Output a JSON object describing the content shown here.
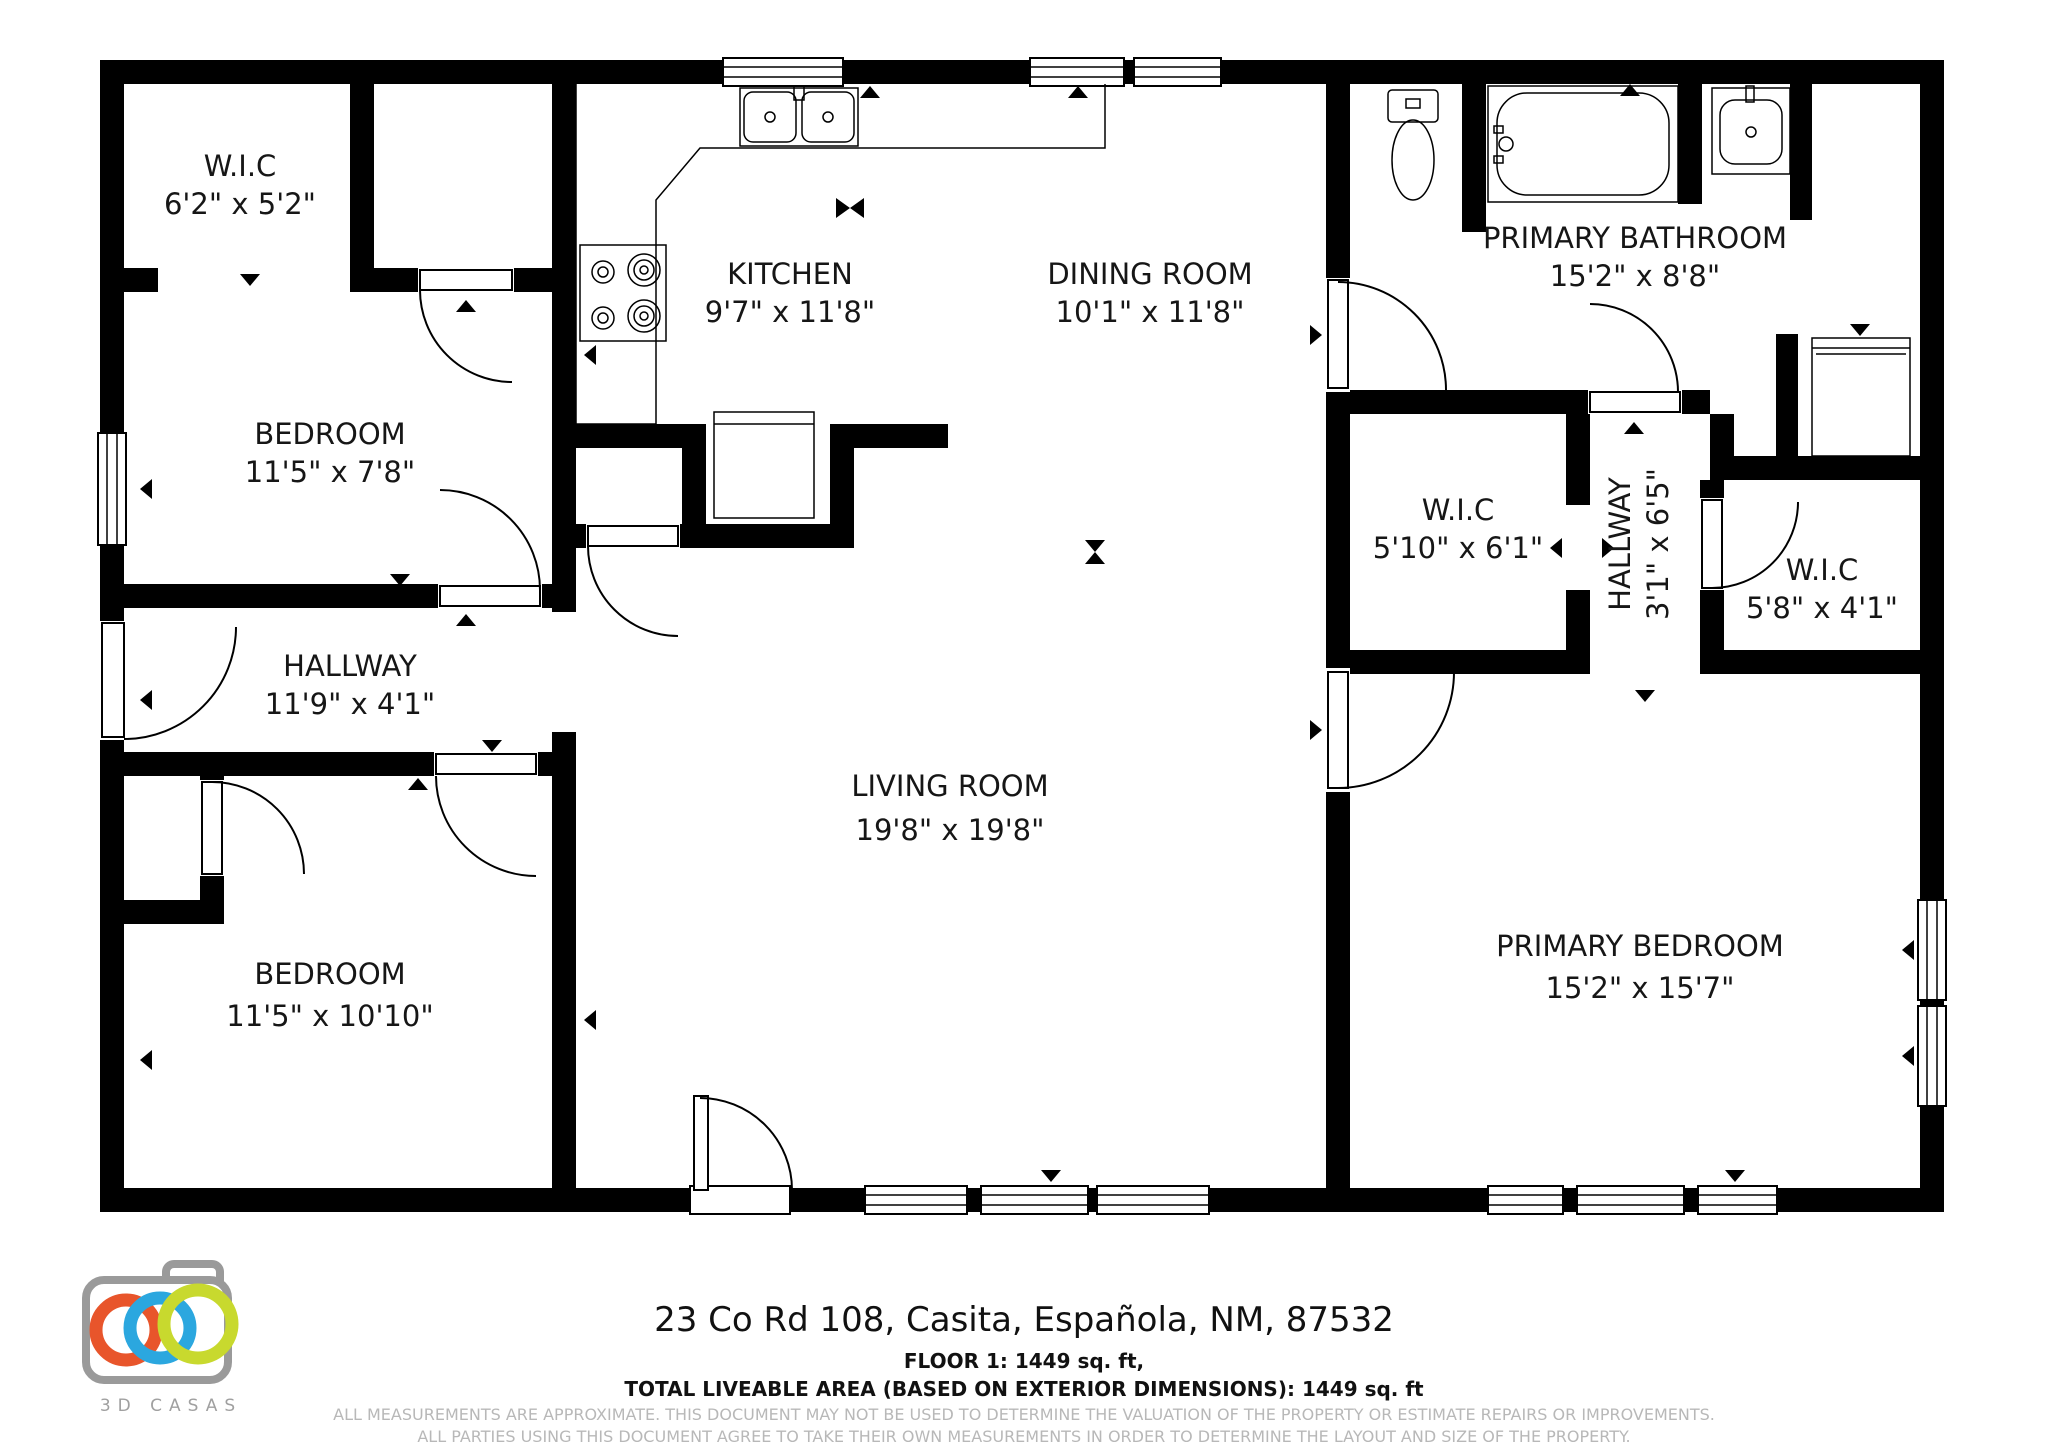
{
  "floor_plan": {
    "rooms": {
      "wic_left": {
        "name": "W.I.C",
        "dims": "6'2\" x 5'2\""
      },
      "bedroom_top": {
        "name": "BEDROOM",
        "dims": "11'5\" x 7'8\""
      },
      "kitchen": {
        "name": "KITCHEN",
        "dims": "9'7\" x 11'8\""
      },
      "dining_room": {
        "name": "DINING ROOM",
        "dims": "10'1\" x 11'8\""
      },
      "primary_bathroom": {
        "name": "PRIMARY BATHROOM",
        "dims": "15'2\" x 8'8\""
      },
      "wic_middle": {
        "name": "W.I.C",
        "dims": "5'10\" x 6'1\""
      },
      "hallway_small": {
        "name": "HALLWAY",
        "dims": "3'1\" x 6'5\""
      },
      "wic_right": {
        "name": "W.I.C",
        "dims": "5'8\" x 4'1\""
      },
      "hallway_main": {
        "name": "HALLWAY",
        "dims": "11'9\" x 4'1\""
      },
      "living_room": {
        "name": "LIVING ROOM",
        "dims": "19'8\" x 19'8\""
      },
      "bedroom_bottom": {
        "name": "BEDROOM",
        "dims": "11'5\" x 10'10\""
      },
      "primary_bedroom": {
        "name": "PRIMARY BEDROOM",
        "dims": "15'2\" x 15'7\""
      }
    }
  },
  "footer": {
    "address": "23 Co Rd 108, Casita, Española, NM, 87532",
    "floor_line": "FLOOR 1: 1449 sq. ft,",
    "total_line": "TOTAL LIVEABLE AREA (BASED ON EXTERIOR DIMENSIONS): 1449 sq. ft",
    "disclaimer_line1": "ALL MEASUREMENTS ARE APPROXIMATE. THIS DOCUMENT MAY NOT BE USED TO DETERMINE THE VALUATION OF THE PROPERTY OR ESTIMATE REPAIRS OR IMPROVEMENTS.",
    "disclaimer_line2": "ALL PARTIES USING THIS DOCUMENT AGREE TO TAKE THEIR OWN MEASUREMENTS IN ORDER TO DETERMINE THE LAYOUT AND SIZE OF THE PROPERTY."
  },
  "logo": {
    "brand": "3D CASAS"
  },
  "colors": {
    "wall": "#000000",
    "label_text": "#161616",
    "disclaimer_text": "#b8b8b8",
    "logo_camera": "#9a9a9a",
    "logo_ring_orange": "#e8552b",
    "logo_ring_blue": "#2ba7df",
    "logo_ring_green": "#c8d92e"
  }
}
